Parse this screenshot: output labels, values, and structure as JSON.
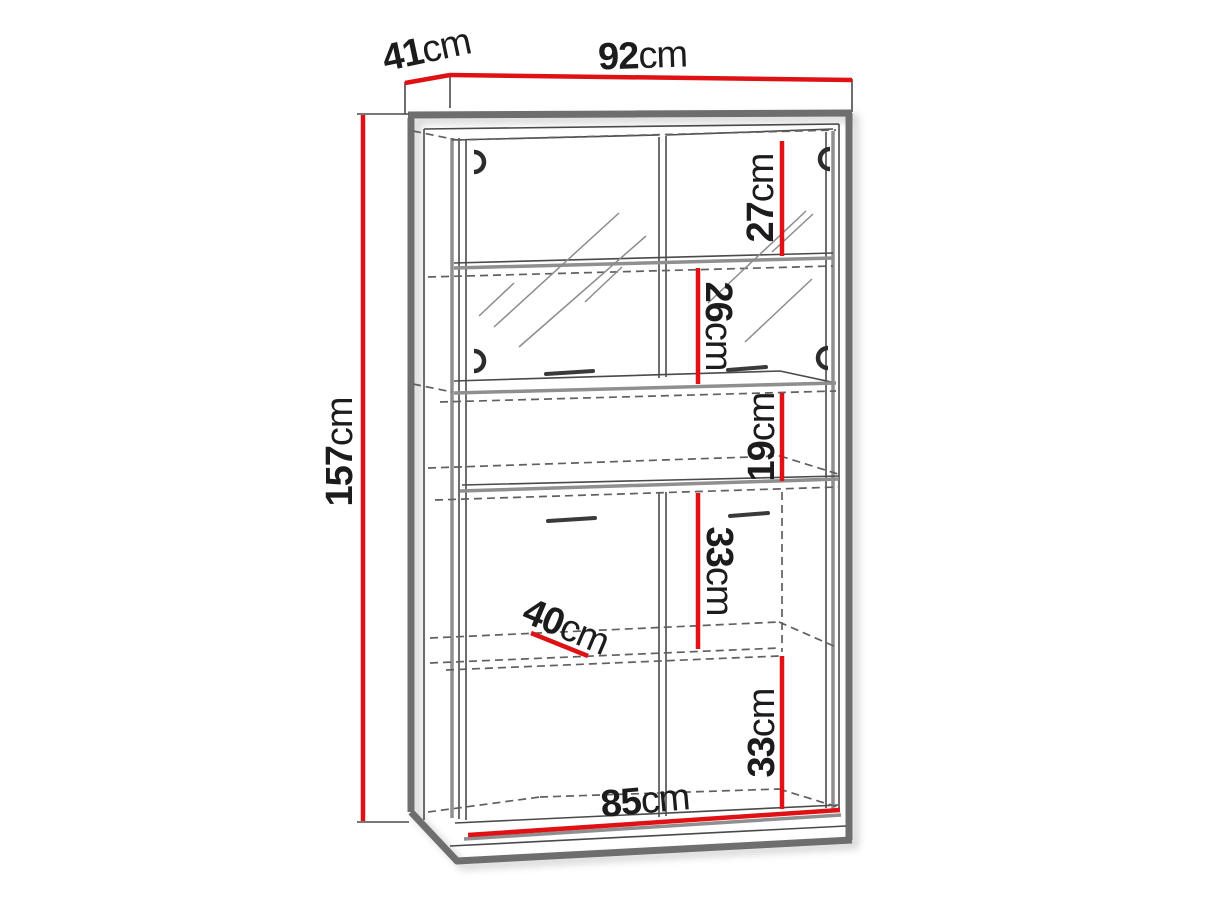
{
  "colors": {
    "dimension_red": "#e01114",
    "outline_gray": "#6e6e6e",
    "text": "#1c1c1c",
    "background": "#ffffff"
  },
  "dimensions": {
    "width": {
      "value": "92",
      "unit": "cm"
    },
    "depth": {
      "value": "41",
      "unit": "cm"
    },
    "height": {
      "value": "157",
      "unit": "cm"
    },
    "sections": [
      {
        "name": "top-compartment-height",
        "value": "27",
        "unit": "cm"
      },
      {
        "name": "second-compartment-height",
        "value": "26",
        "unit": "cm"
      },
      {
        "name": "niche-height",
        "value": "19",
        "unit": "cm"
      },
      {
        "name": "third-compartment-height",
        "value": "33",
        "unit": "cm"
      },
      {
        "name": "bottom-compartment-height",
        "value": "33",
        "unit": "cm"
      },
      {
        "name": "shelf-depth",
        "value": "40",
        "unit": "cm"
      },
      {
        "name": "interior-width",
        "value": "85",
        "unit": "cm"
      }
    ]
  }
}
